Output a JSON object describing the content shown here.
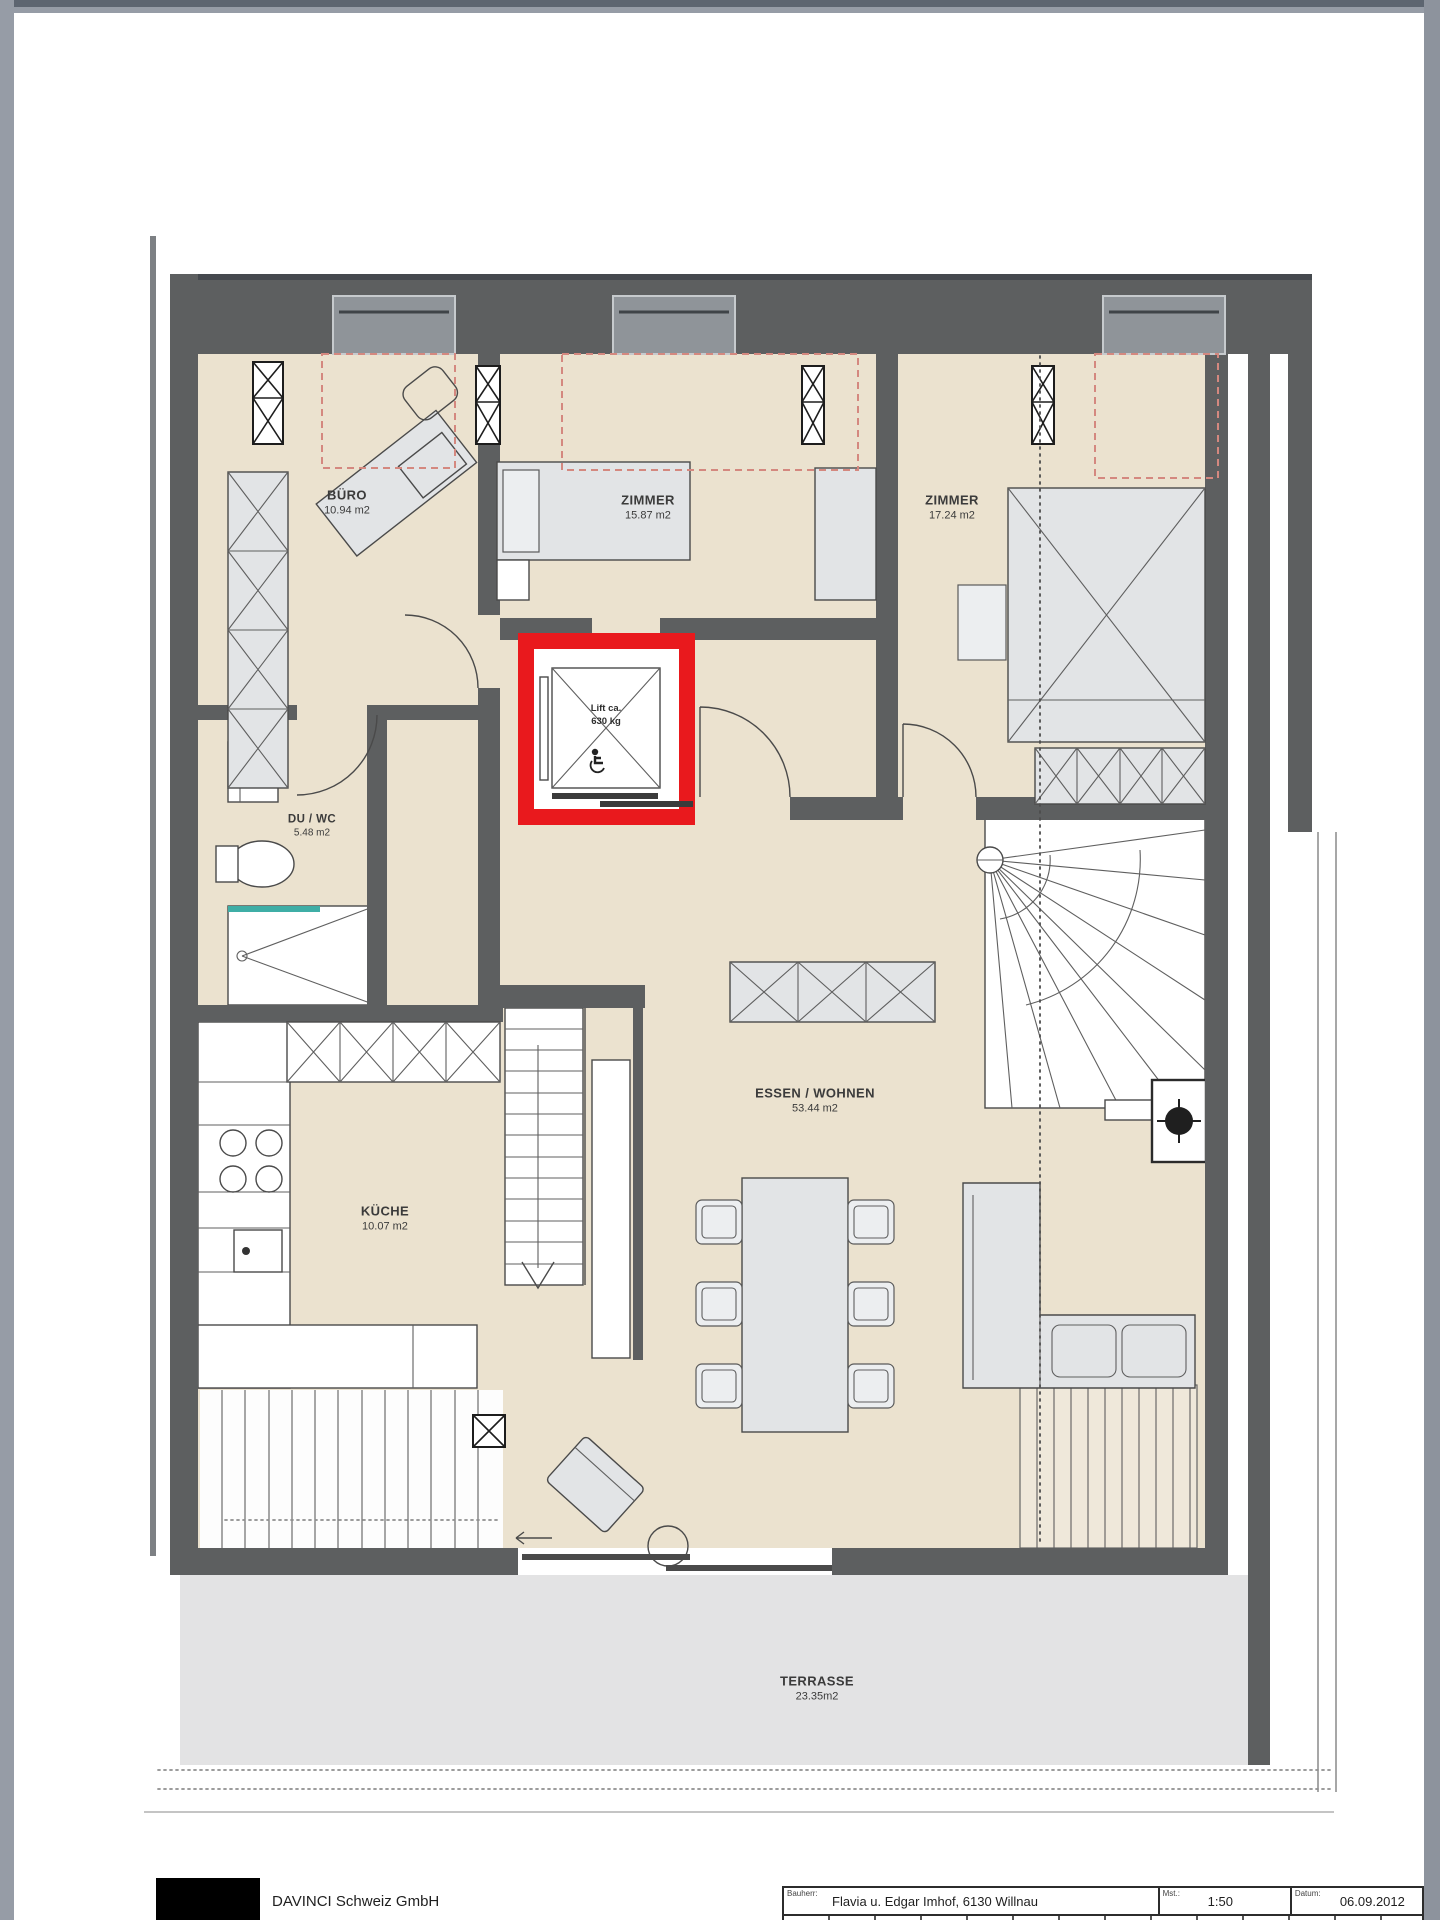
{
  "rooms": [
    {
      "name": "BÜRO",
      "area": "10.94 m2"
    },
    {
      "name": "ZIMMER",
      "area": "15.87 m2"
    },
    {
      "name": "ZIMMER",
      "area": "17.24 m2"
    },
    {
      "name": "DU / WC",
      "area": "5.48 m2"
    },
    {
      "name": "KÜCHE",
      "area": "10.07 m2"
    },
    {
      "name": "ESSEN / WOHNEN",
      "area": "53.44 m2"
    },
    {
      "name": "TERRASSE",
      "area": "23.35m2"
    }
  ],
  "lift": {
    "line1": "Lift ca.",
    "line2": "630 kg"
  },
  "title_block": {
    "company": "DAVINCI Schweiz GmbH",
    "fields": [
      {
        "label": "Bauherr:",
        "value": "Flavia u. Edgar Imhof, 6130 Willnau"
      },
      {
        "label": "Mst.:",
        "value": "1:50"
      },
      {
        "label": "Datum:",
        "value": "06.09.2012"
      }
    ]
  },
  "colors": {
    "wall-color": "#5d5f60",
    "floor-color": "#ebe2cf",
    "terrace-color": "#e3e3e4",
    "furniture-fill": "#e2e4e6",
    "lift-red": "#e9191d",
    "skylight-red": "#d4887f",
    "teal-color": "#3faea6"
  }
}
